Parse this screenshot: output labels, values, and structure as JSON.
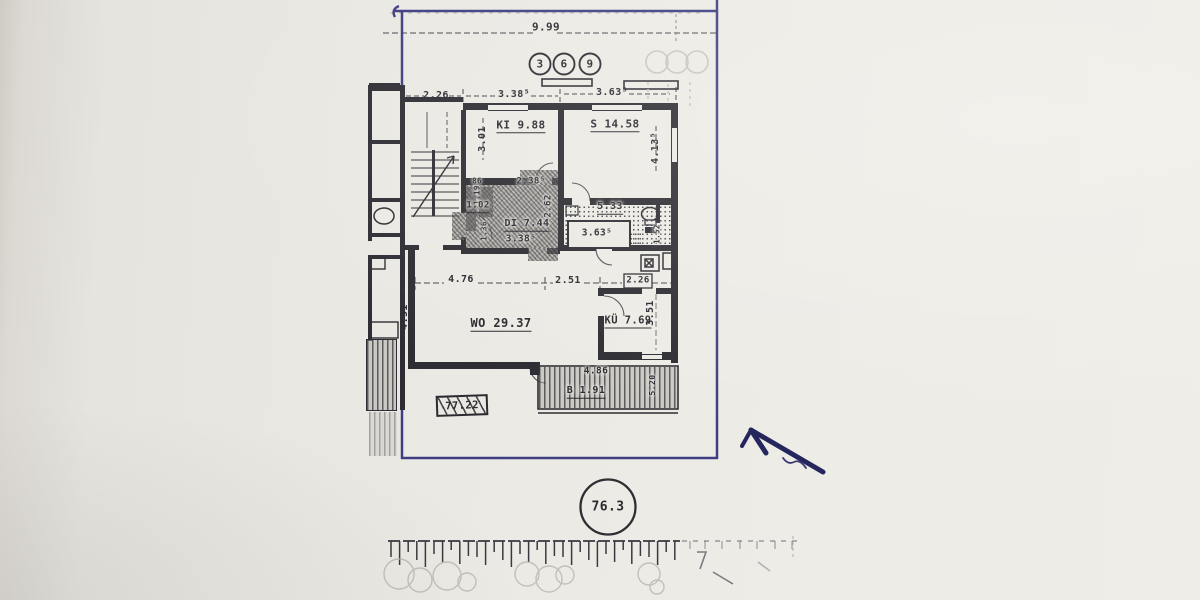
{
  "plan_labels": {
    "overall_width": "9.99",
    "stair_width": "2.26",
    "ki_width": "3.38⁵",
    "s_width": "3.63⁵",
    "ki_depth": "3.01",
    "s_depth": "4.13⁵",
    "room_ki": "KI 9.88",
    "room_s": "S 14.58",
    "hall_width_top": "2.38⁵",
    "hall_depth": "2.62",
    "room_hall": "DI 7.44",
    "hall_width": "3.38⁵",
    "store_width": "86",
    "store_depth": "1.19",
    "room_store": "1.02",
    "store_side": "1.36",
    "room_bath": "5.33",
    "bath_width": "3.63⁵",
    "bath_depth": "1.52",
    "wo_seg1": "4.76",
    "wo_seg2": "2.51",
    "wo_seg3": "2.26",
    "wo_depth": "4.51",
    "room_wo": "WO 29.37",
    "room_kitchen": "KÜ 7.69",
    "kitchen_depth": "3.51",
    "balcony_width": "4.86",
    "room_balcony": "B 1.91",
    "balcony_side": "5.20",
    "area_total_boxed": "77.22",
    "area_total_circled": "76.3",
    "unit_badges": [
      "3",
      "6",
      "9"
    ]
  }
}
